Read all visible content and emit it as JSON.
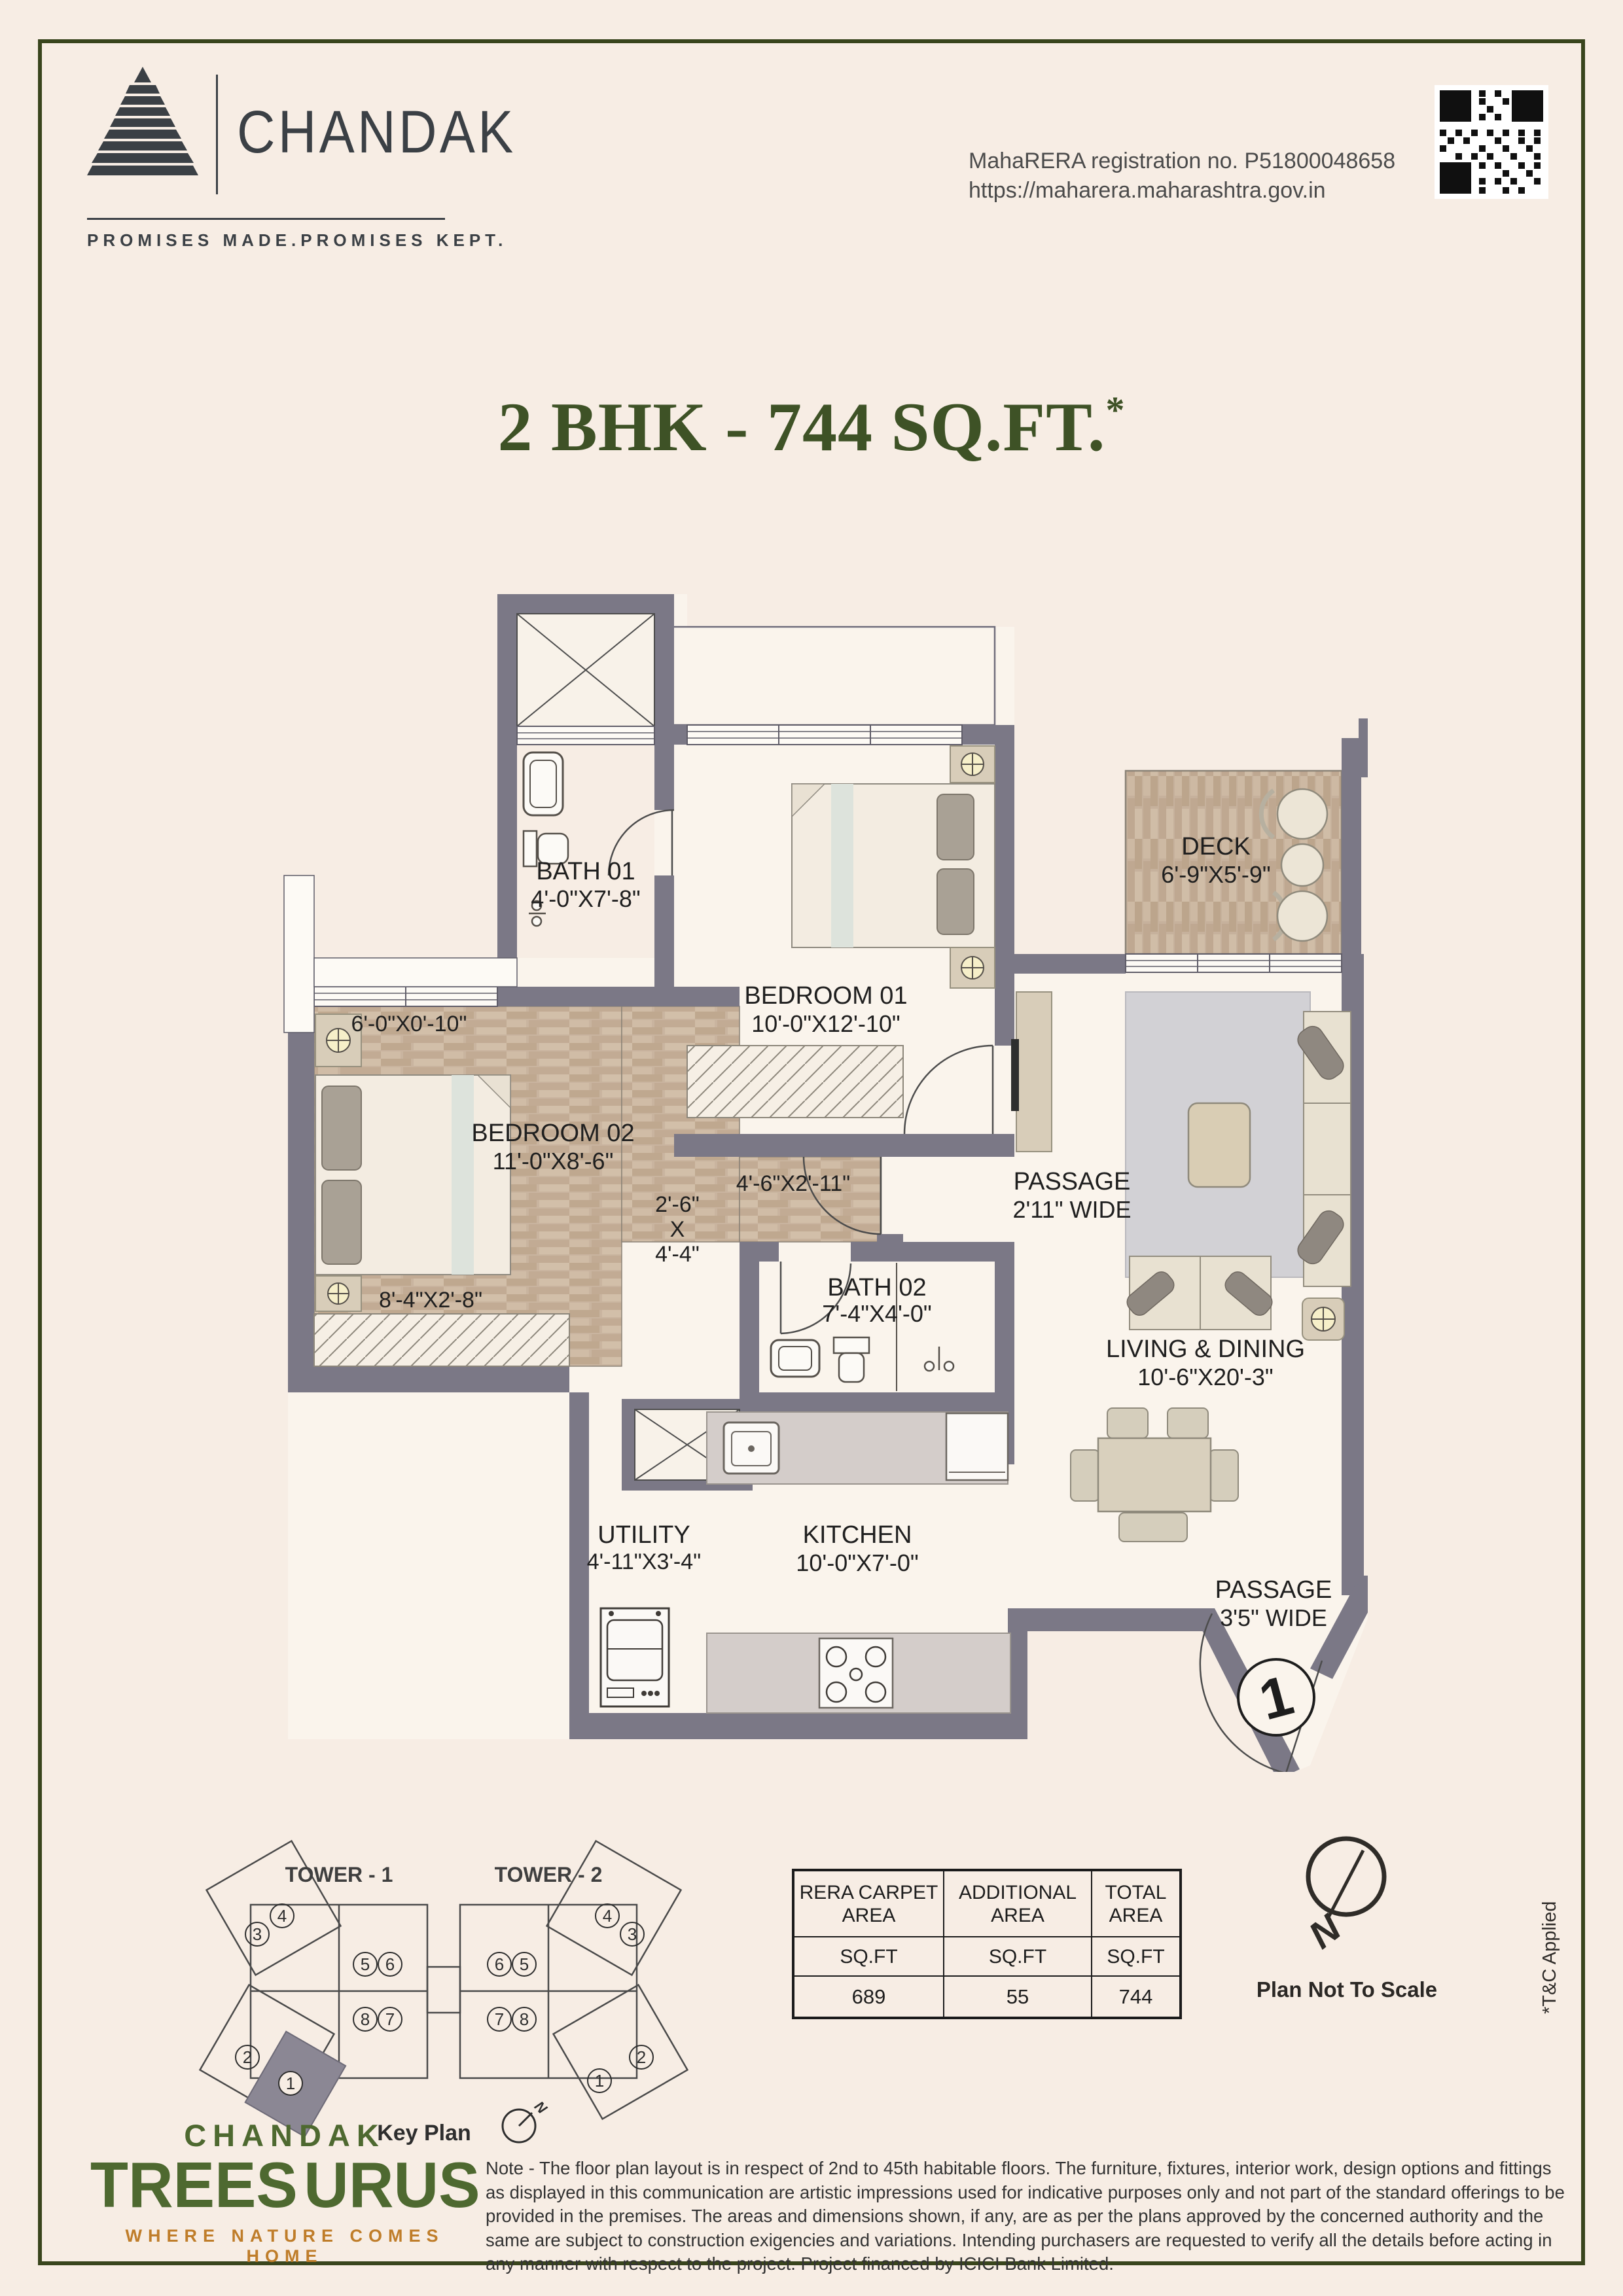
{
  "header": {
    "brand": "CHANDAK",
    "tagline": "PROMISES MADE.PROMISES KEPT.",
    "rera_line1": "MahaRERA registration no. P51800048658",
    "rera_line2": "https://maharera.maharashtra.gov.in"
  },
  "title": {
    "main": "2 BHK - 744 SQ.FT.",
    "sup": "*"
  },
  "plan": {
    "rooms": {
      "bath01": {
        "name": "BATH 01",
        "dims": "4'-0\"X7'-8\""
      },
      "bedroom01": {
        "name": "BEDROOM 01",
        "dims": "10'-0\"X12'-10\""
      },
      "deck": {
        "name": "DECK",
        "dims": "6'-9\"X5'-9\""
      },
      "bedroom02": {
        "name": "BEDROOM 02",
        "dims": "11'-0\"X8'-6\""
      },
      "bath02": {
        "name": "BATH 02",
        "dims": "7'-4\"X4'-0\""
      },
      "living": {
        "name": "LIVING & DINING",
        "dims": "10'-6\"X20'-3\""
      },
      "utility": {
        "name": "UTILITY",
        "dims": "4'-11\"X3'-4\""
      },
      "kitchen": {
        "name": "KITCHEN",
        "dims": "10'-0\"X7'-0\""
      },
      "passage1": {
        "name": "PASSAGE",
        "dims": "2'11\" WIDE"
      },
      "passage2": {
        "name": "PASSAGE",
        "dims": "3'5\" WIDE"
      }
    },
    "dims": {
      "niche": "6'-0\"X0'-10\"",
      "wardrobe2": "8'-4\"X2'-8\"",
      "nook_w": "2'-6\"",
      "nook_x": "X",
      "nook_h": "4'-4\"",
      "wardrobe1": "4'-6\"X2'-11\""
    },
    "unit_marker": "1"
  },
  "key_plan": {
    "tower1": "TOWER - 1",
    "tower2": "TOWER - 2",
    "caption": "Key Plan",
    "north": "N",
    "t1_units": [
      "3",
      "4",
      "5",
      "6",
      "8",
      "7",
      "2",
      "1"
    ],
    "t2_units": [
      "6",
      "5",
      "7",
      "8",
      "4",
      "3",
      "1",
      "2"
    ]
  },
  "area_table": {
    "headers": [
      [
        "RERA CARPET",
        "AREA"
      ],
      [
        "ADDITIONAL",
        "AREA"
      ],
      [
        "TOTAL",
        "AREA"
      ]
    ],
    "units": [
      "SQ.FT",
      "SQ.FT",
      "SQ.FT"
    ],
    "values": [
      "689",
      "55",
      "744"
    ]
  },
  "compass": {
    "n": "N",
    "caption": "Plan Not To Scale"
  },
  "tnc": "*T&C Applied",
  "footer": {
    "brand_line1": "CHANDAK",
    "brand_left": "TREES",
    "brand_right": "URUS",
    "tagline": "WHERE NATURE COMES HOME",
    "note": "Note - The floor plan layout is in respect of 2nd to 45th habitable floors. The furniture, fixtures, interior work, design options and fittings as displayed in this communication are artistic impressions used for indicative purposes only and not part of the standard offerings to be provided in the premises. The areas and dimensions shown, if any, are as per the plans approved by the concerned authority and the same are subject to construction exigencies and variations. Intending purchasers are requested to verify all the details before acting in any manner with respect to the project. Project financed by ICICI Bank Limited."
  }
}
